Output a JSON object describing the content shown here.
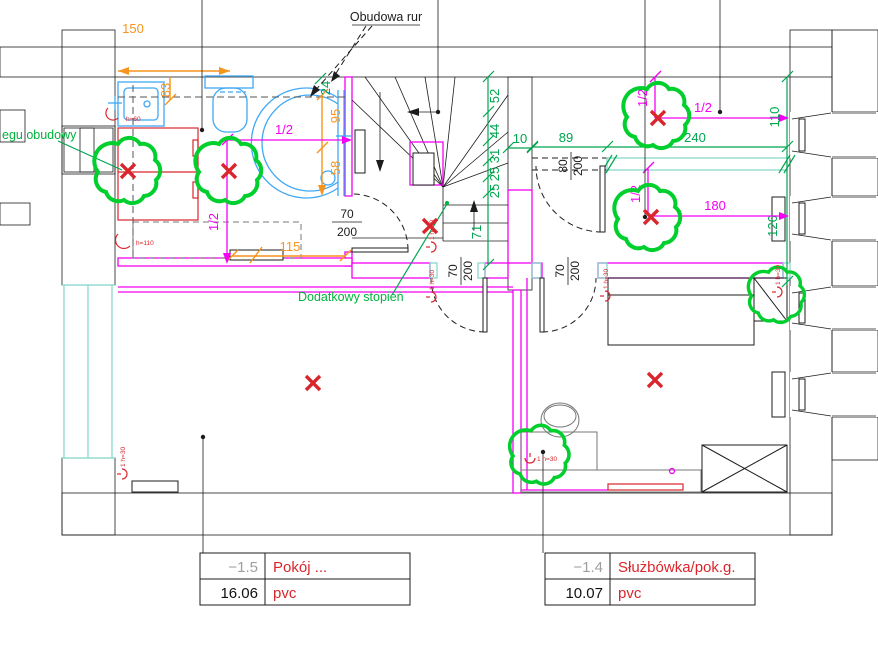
{
  "callouts": {
    "pipe_boxing": "Obudowa rur",
    "boxing_edge": "egu obudowy",
    "extra_step": "Dodatkowy stopień"
  },
  "dimensions": {
    "orange": {
      "d150": "150",
      "d83": "83",
      "d95": "95",
      "d58": "58",
      "d115": "115"
    },
    "green": {
      "d89": "89",
      "d240": "240",
      "d110": "110",
      "d126": "126",
      "d52": "52",
      "d44": "44",
      "d31": "31",
      "d25a": "25",
      "d25b": "25",
      "d71": "71",
      "d10": "10",
      "d24": "24"
    },
    "magenta": {
      "half": "1/2",
      "d180": "180"
    }
  },
  "doors": {
    "d70_w": "70",
    "d70_h": "200",
    "d80_w": "80",
    "d80_h": "200"
  },
  "plumbing": {
    "h30": "1 h=30",
    "h60": "h=60",
    "h110": "h=110"
  },
  "rooms": [
    {
      "level": "−1.5",
      "name": "Pokój ...",
      "area": "16.06",
      "floor": "pvc"
    },
    {
      "level": "−1.4",
      "name": "Służbówka/pok.g.",
      "area": "10.07",
      "floor": "pvc"
    }
  ],
  "colors": {
    "wall": "#c8c8c8",
    "accent_magenta": "#f400f4",
    "accent_green": "#00a550",
    "accent_orange": "#f7941d",
    "tree_green": "#00cf2e",
    "mark_red": "#d9262c",
    "fixture_blue": "#3fa9f5",
    "window_cyan": "#7fd4c8"
  }
}
